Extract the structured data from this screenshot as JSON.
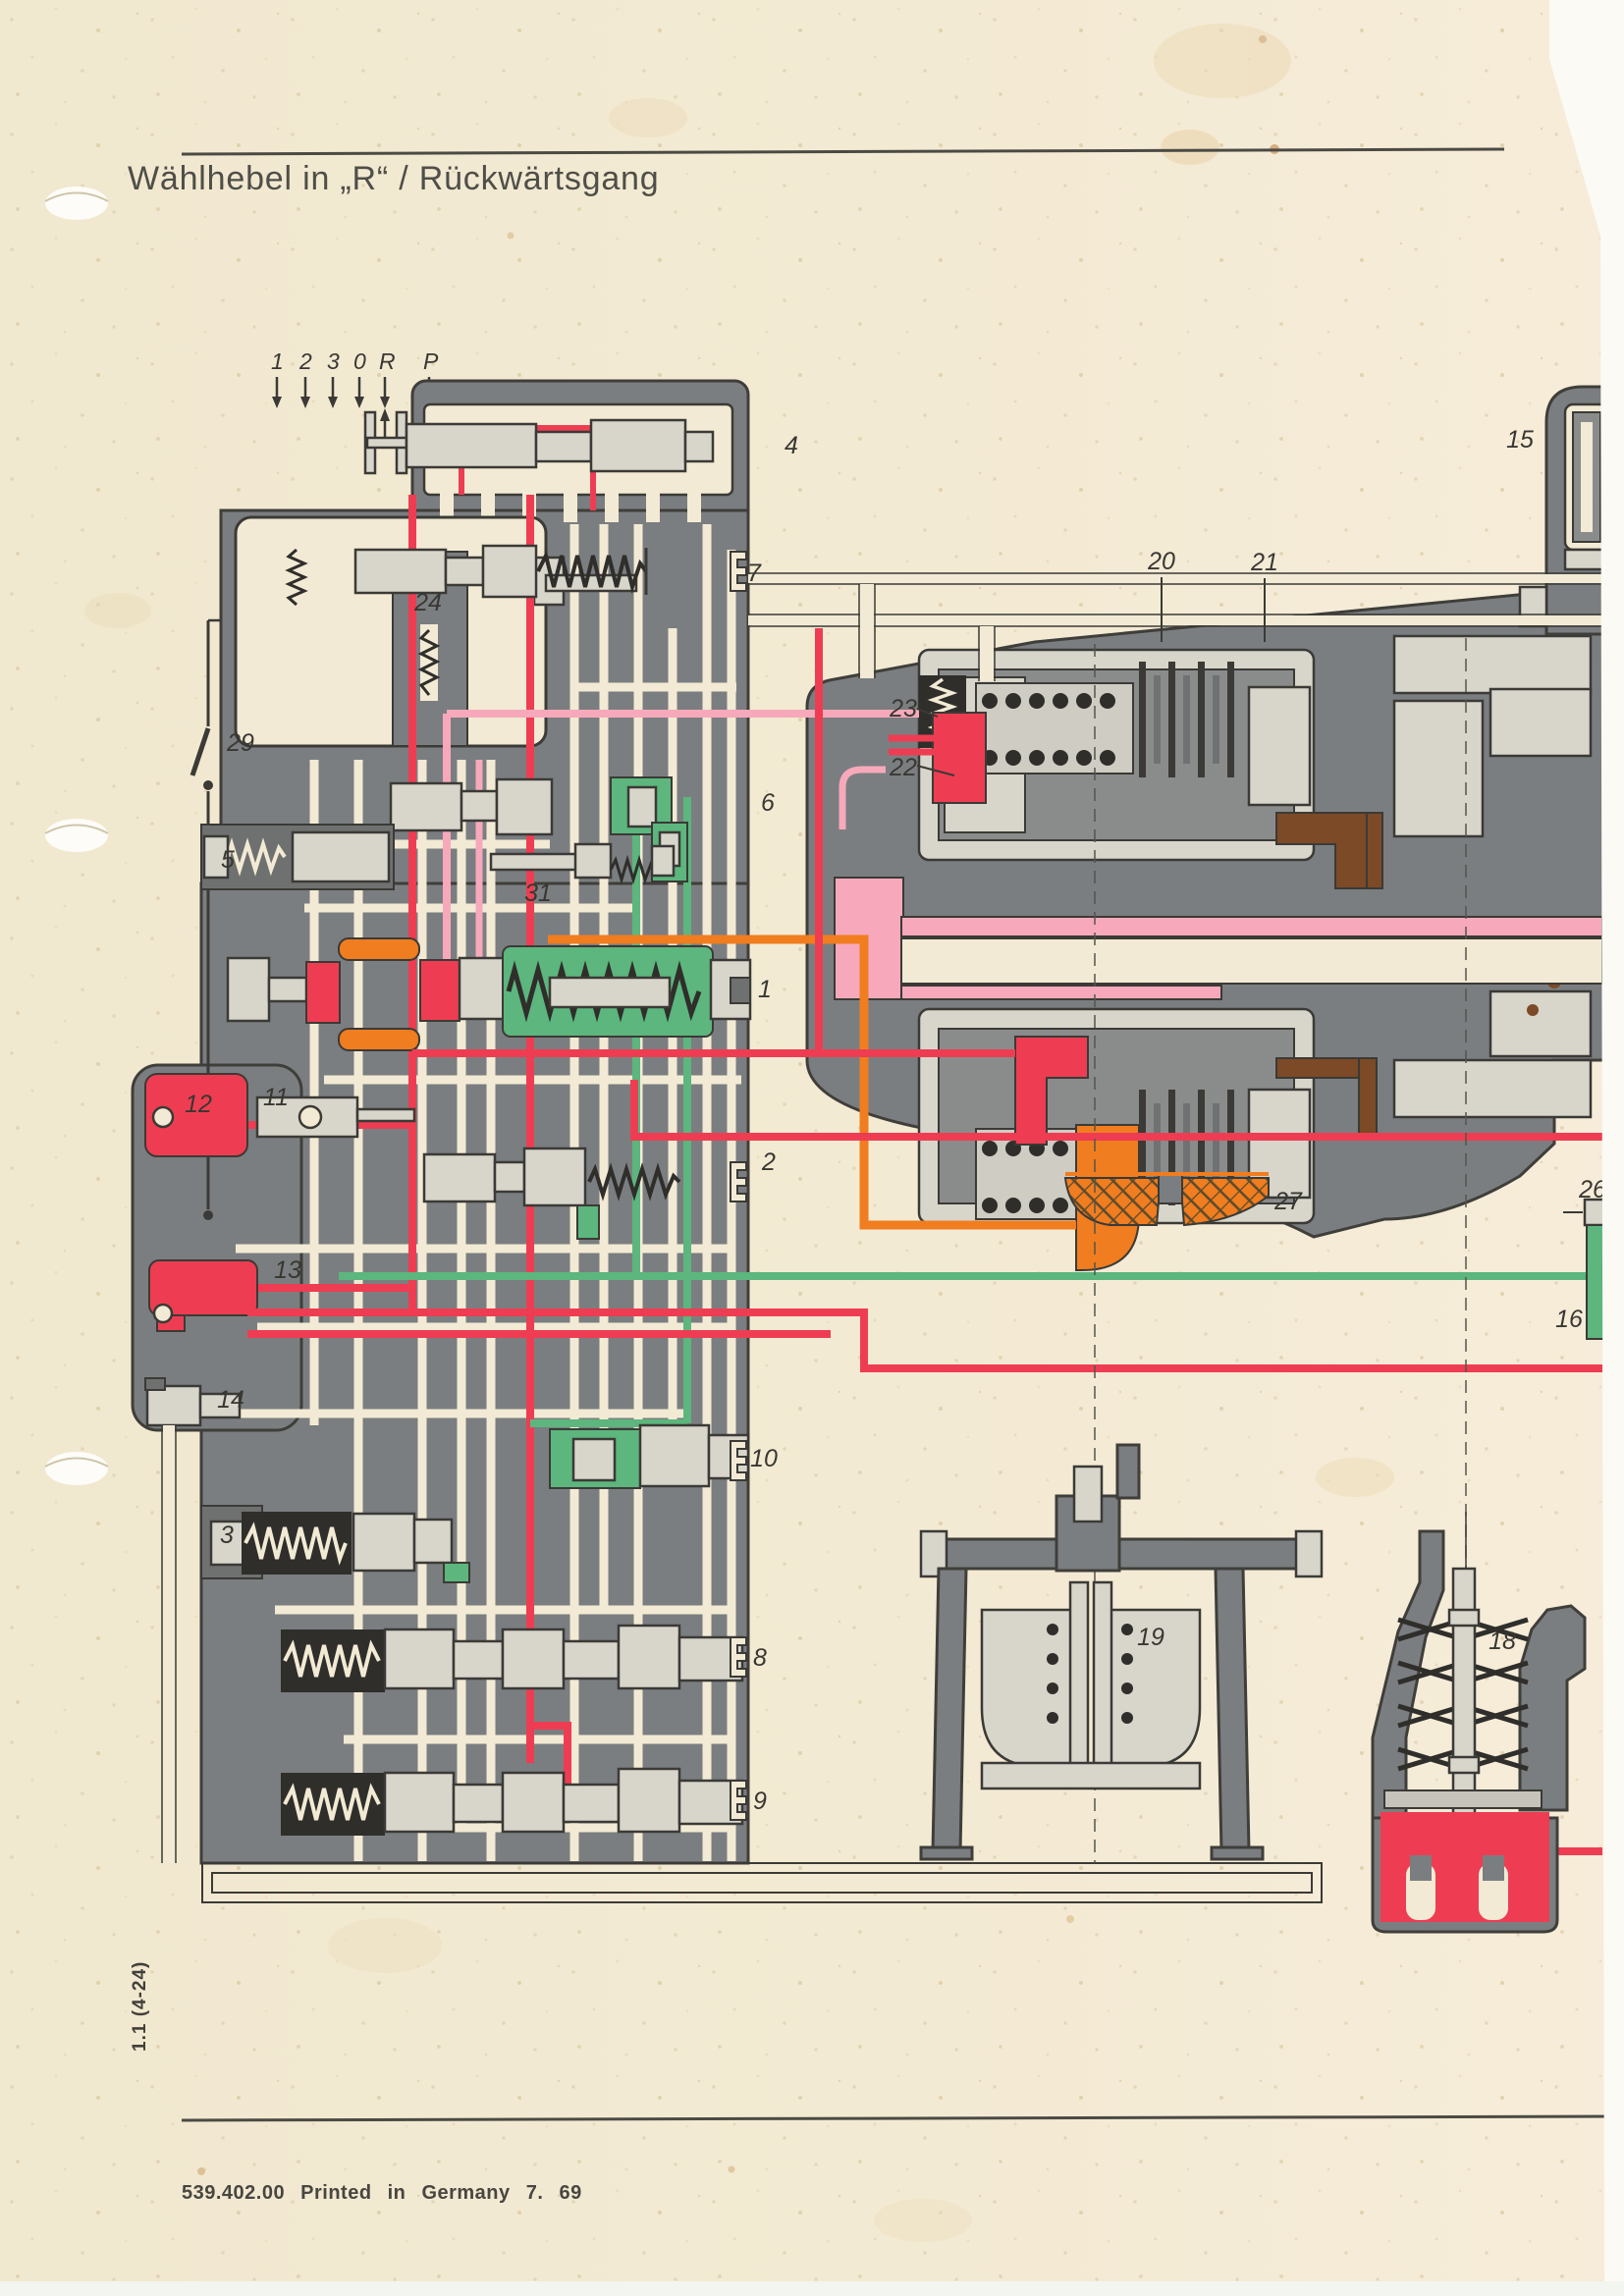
{
  "page": {
    "title": "Wählhebel in „R“ / Rückwärtsgang",
    "footer": "539.402.00  Printed in Germany  7. 69",
    "side_label": "1.1 (4-24)"
  },
  "selector": {
    "positions": [
      "1",
      "2",
      "3",
      "0",
      "R",
      "P"
    ]
  },
  "callouts": {
    "c1": "1",
    "c2": "2",
    "c3": "3",
    "c4": "4",
    "c5": "5",
    "c6": "6",
    "c7": "7",
    "c8": "8",
    "c9": "9",
    "c10": "10",
    "c11": "11",
    "c12": "12",
    "c13": "13",
    "c14": "14",
    "c15": "15",
    "c16": "16",
    "c18": "18",
    "c19": "19",
    "c20": "20",
    "c21": "21",
    "c22": "22",
    "c23": "23",
    "c24": "24",
    "c26": "26",
    "c27": "27",
    "c29": "29",
    "c31": "31"
  },
  "palette": {
    "paper": "#f2ead4",
    "body_gray": "#7b7e80",
    "spool_gray": "#d8d5cb",
    "outline": "#3b3a36",
    "line_red": "#ee3d52",
    "line_pink": "#f7a9bb",
    "line_green": "#5cb67d",
    "line_orange": "#f07d1f",
    "seal_brown": "#7c4a27"
  }
}
